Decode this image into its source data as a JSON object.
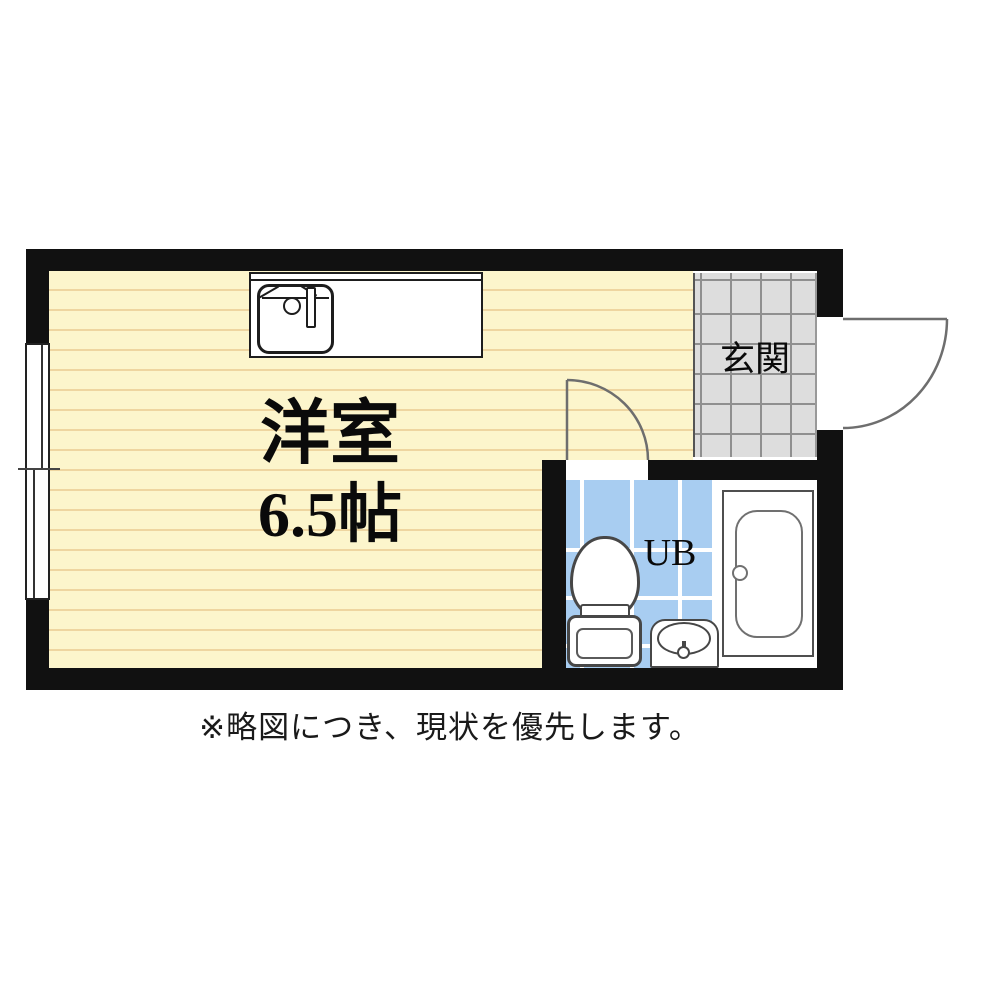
{
  "floorplan": {
    "rooms": {
      "main_room": {
        "label": "洋室",
        "area": "6.5帖"
      },
      "entrance": {
        "label": "玄関"
      },
      "unit_bath": {
        "label": "UB"
      }
    },
    "note": "※略図につき、現状を優先します。",
    "colors": {
      "wall": "#111111",
      "flooring": "#fcf5cc",
      "flooring_line": "#eed5a0",
      "entrance_tile": "#dddddd",
      "entrance_tile_line": "#8f8f8f",
      "bath_tile": "#a8cdf1",
      "bath_tile_line": "#ffffff"
    }
  }
}
